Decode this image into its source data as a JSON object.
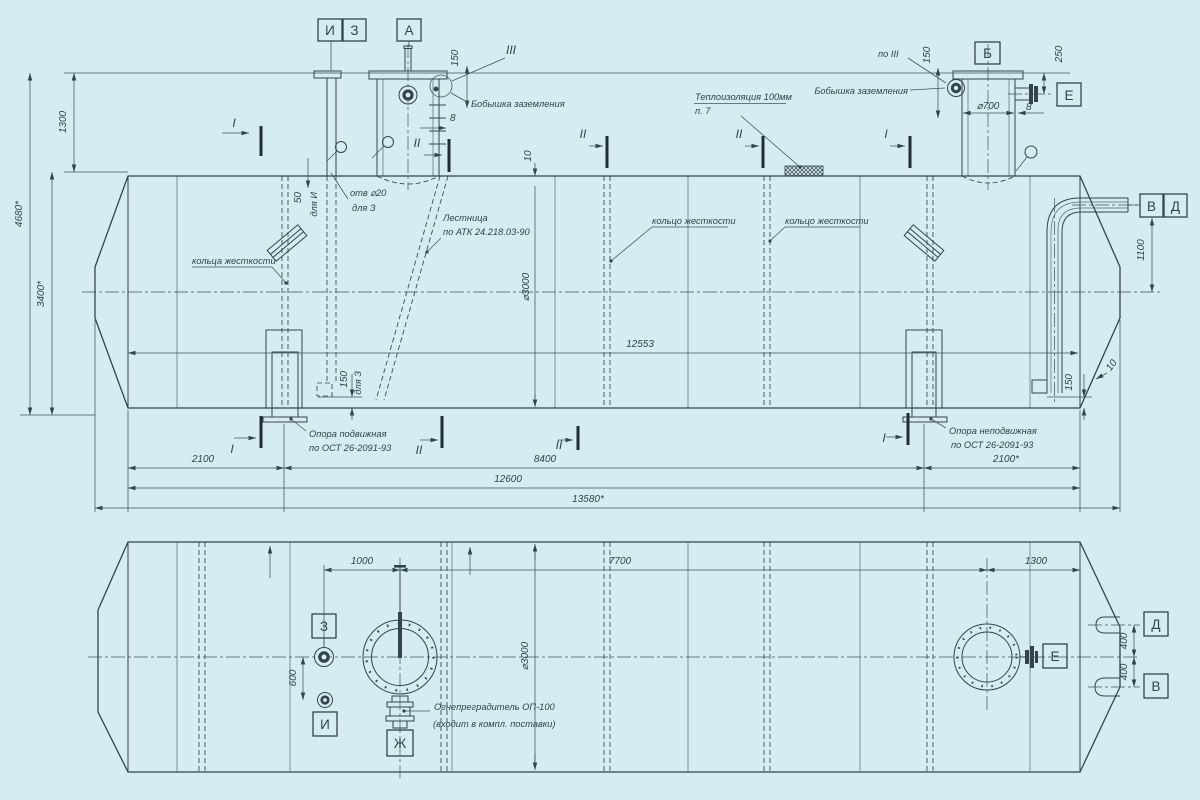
{
  "palette": {
    "background": "#d5edf0",
    "ink": "#33444d"
  },
  "view_markers": {
    "i": "И",
    "z": "З",
    "a": "А",
    "b": "Б",
    "e": "Е",
    "v": "В",
    "d": "Д",
    "zh": "Ж"
  },
  "sections": {
    "s1": "I",
    "s2": "II",
    "s3": "III",
    "po_s3": "по III"
  },
  "dims": {
    "d1300": "1300",
    "d3400": "3400*",
    "d4680": "4680*",
    "d150": "150",
    "d8": "8",
    "d10": "10",
    "d50": "50",
    "d250": "250",
    "d700": "⌀700",
    "d3000": "⌀3000",
    "d12553": "12553",
    "d1100": "1100",
    "d2100": "2100",
    "d8400": "8400",
    "d2100s": "2100*",
    "d12600": "12600",
    "d13580": "13580*",
    "d1000": "1000",
    "d7700": "7700",
    "d600": "600",
    "d400": "400",
    "hole20": "отв ⌀20"
  },
  "notes": {
    "for_z": "для З",
    "for_i": "для И",
    "ground": "Бобышка заземления",
    "insul1": "Теплоизоляция 100мм",
    "insul2": "п. 7",
    "ladder1": "Лестница",
    "ladder2": "по АТК 24.218.03-90",
    "rings_pl": "кольца жесткости",
    "ring_sg": "кольцо жесткости",
    "sup_mov": "Опора подвижная",
    "sup_fix": "Опора неподвижная",
    "sup_std": "по ОСТ 26-2091-93",
    "arrest1": "Огнепреградитель ОП-100",
    "arrest2": "(входит в компл. поставки)"
  }
}
